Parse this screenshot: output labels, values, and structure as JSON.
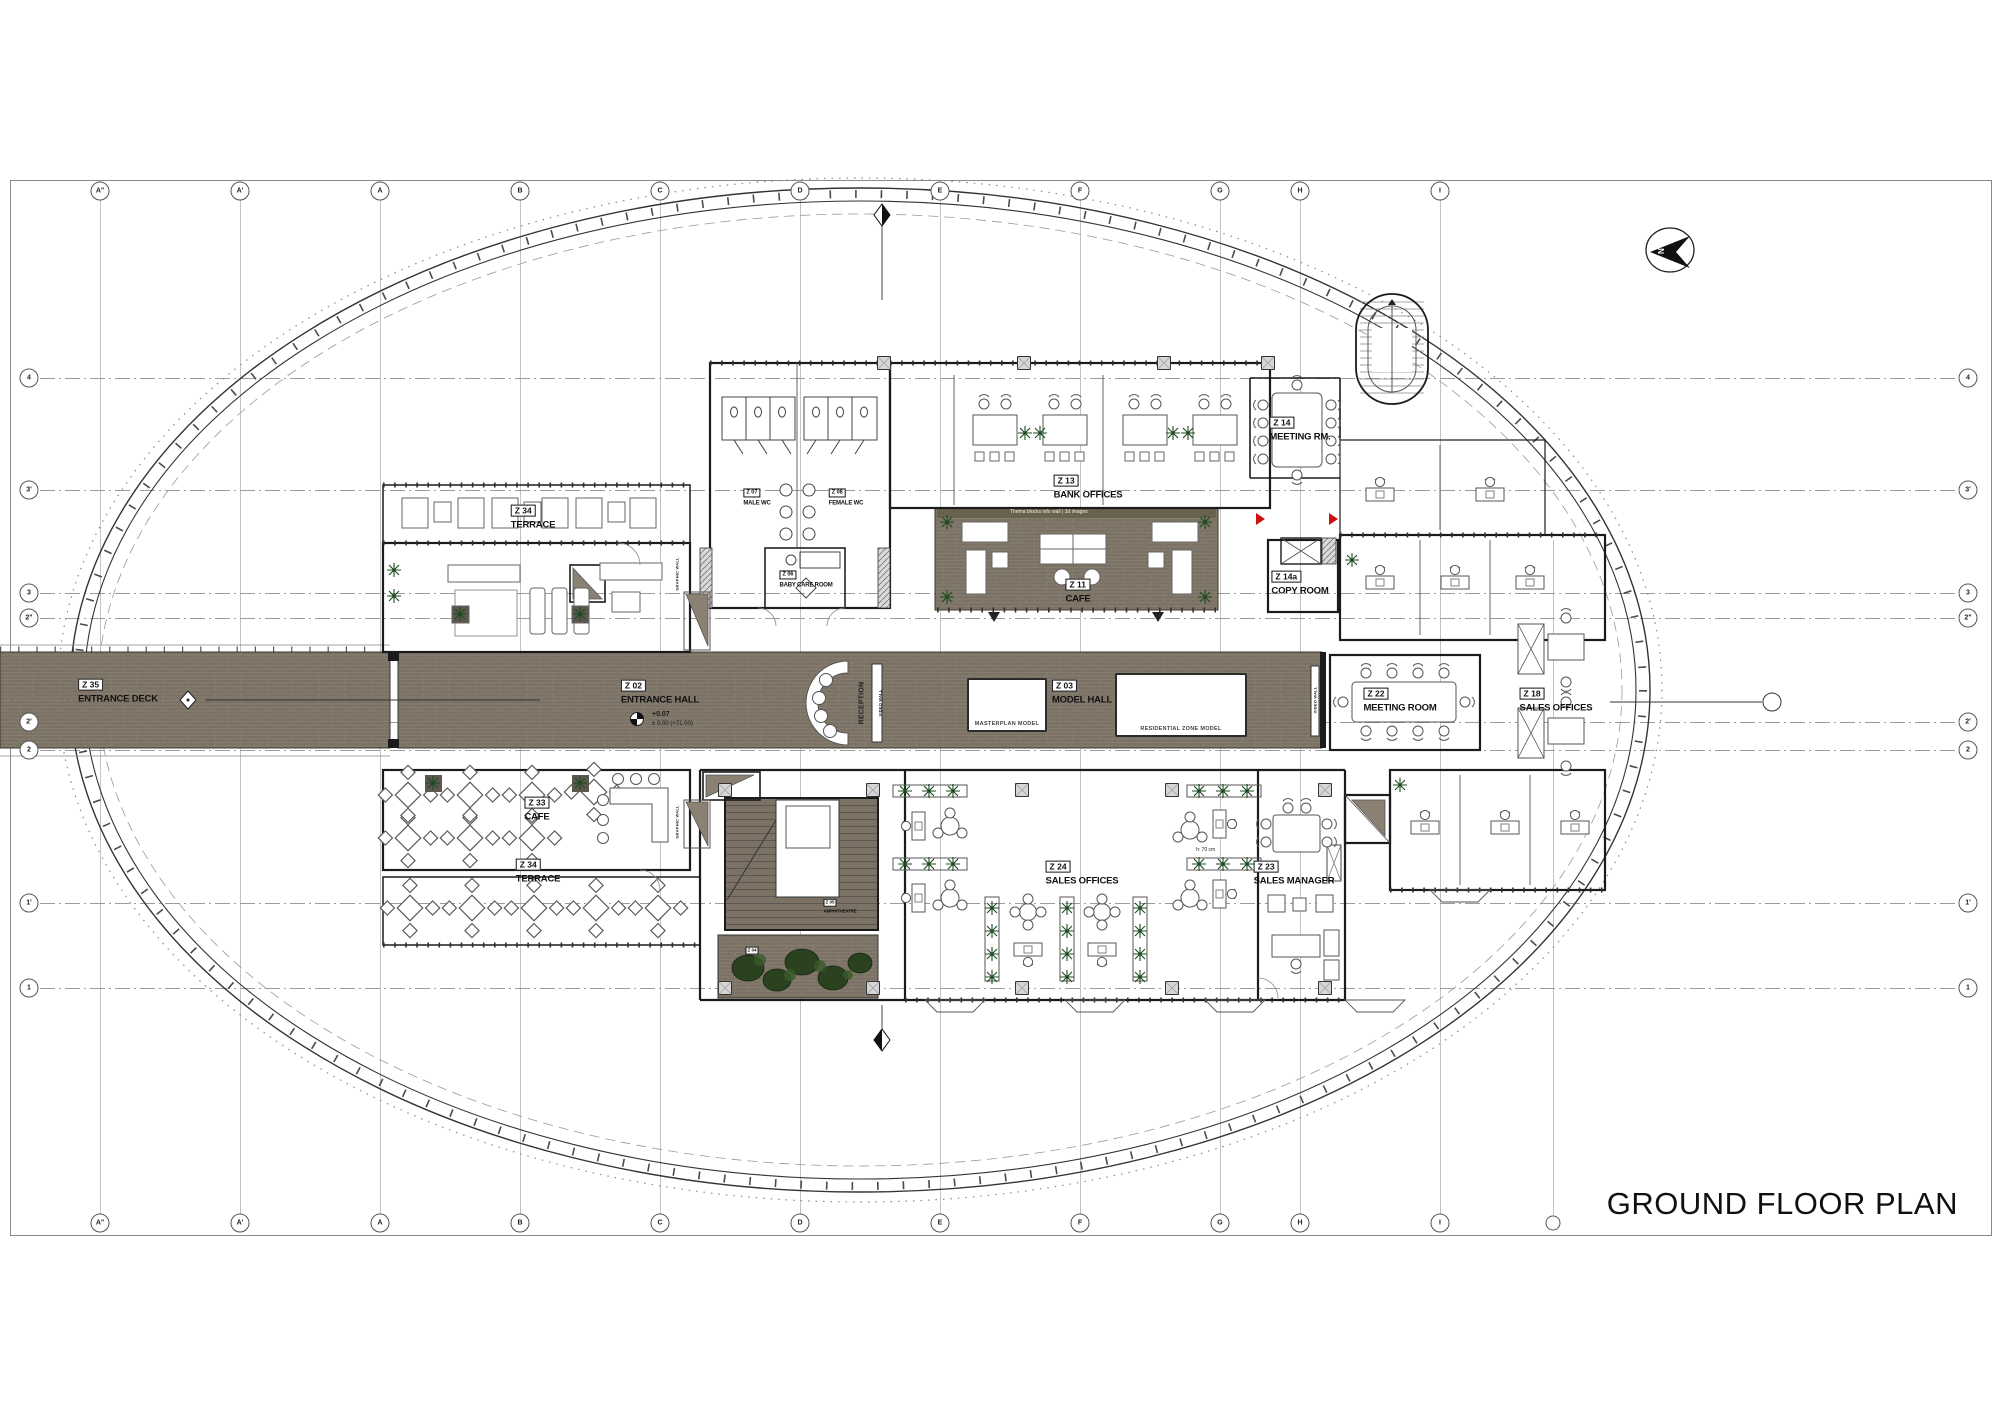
{
  "title": "GROUND FLOOR PLAN",
  "grid": {
    "marker_top_y": 191,
    "marker_bottom_y": 1223,
    "line_top": 200,
    "line_bottom": 1215,
    "marker_left_x": 29,
    "marker_right_x": 1968,
    "line_left": 40,
    "line_right": 1956,
    "columns": [
      {
        "label": "A\"",
        "x": 100
      },
      {
        "label": "A'",
        "x": 240
      },
      {
        "label": "A",
        "x": 380
      },
      {
        "label": "B",
        "x": 520
      },
      {
        "label": "C",
        "x": 660
      },
      {
        "label": "D",
        "x": 800
      },
      {
        "label": "E",
        "x": 940
      },
      {
        "label": "F",
        "x": 1080
      },
      {
        "label": "G",
        "x": 1220
      },
      {
        "label": "H",
        "x": 1300
      },
      {
        "label": "I",
        "x": 1440
      }
    ],
    "extra_columns": [
      {
        "label": "",
        "x": 1553,
        "y1": 540,
        "y2": 1215
      }
    ],
    "rows": [
      {
        "label": "4",
        "y": 378
      },
      {
        "label": "3'",
        "y": 490
      },
      {
        "label": "3",
        "y": 593
      },
      {
        "label": "2\"",
        "y": 618
      },
      {
        "label": "2'",
        "y": 722
      },
      {
        "label": "2",
        "y": 750
      },
      {
        "label": "1'",
        "y": 903
      },
      {
        "label": "1",
        "y": 988
      }
    ]
  },
  "rooms": [
    {
      "id": "Z 35",
      "name": "ENTRANCE DECK",
      "x": 118,
      "y": 690,
      "size": "md"
    },
    {
      "id": "Z 02",
      "name": "ENTRANCE HALL",
      "x": 660,
      "y": 691,
      "size": "md"
    },
    {
      "id": "Z 03",
      "name": "MODEL HALL",
      "x": 1082,
      "y": 691,
      "size": "md"
    },
    {
      "id": "Z 34",
      "name": "TERRACE",
      "x": 533,
      "y": 516,
      "size": "md"
    },
    {
      "id": "Z 13",
      "name": "BANK OFFICES",
      "x": 1088,
      "y": 486,
      "size": "md"
    },
    {
      "id": "Z 14",
      "name": "MEETING RM.",
      "x": 1300,
      "y": 428,
      "size": "md"
    },
    {
      "id": "Z 11",
      "name": "CAFE",
      "x": 1078,
      "y": 590,
      "size": "md"
    },
    {
      "id": "Z 14a",
      "name": "COPY ROOM",
      "x": 1300,
      "y": 582,
      "size": "md"
    },
    {
      "id": "Z 07",
      "name": "MALE WC",
      "x": 757,
      "y": 494,
      "size": "sm"
    },
    {
      "id": "Z 08",
      "name": "FEMALE WC",
      "x": 846,
      "y": 494,
      "size": "sm"
    },
    {
      "id": "Z 06",
      "name": "BABY CARE ROOM",
      "x": 806,
      "y": 576,
      "size": "sm"
    },
    {
      "id": "Z 22",
      "name": "MEETING ROOM",
      "x": 1400,
      "y": 699,
      "size": "md"
    },
    {
      "id": "Z 18",
      "name": "SALES OFFICES",
      "x": 1556,
      "y": 699,
      "size": "md"
    },
    {
      "id": "Z 33",
      "name": "CAFE",
      "x": 537,
      "y": 808,
      "size": "md"
    },
    {
      "id": "Z 34",
      "name": "TERRACE",
      "x": 538,
      "y": 870,
      "size": "md"
    },
    {
      "id": "Z 24",
      "name": "SALES OFFICES",
      "x": 1082,
      "y": 872,
      "size": "md"
    },
    {
      "id": "Z 23",
      "name": "SALES MANAGER",
      "x": 1294,
      "y": 872,
      "size": "md"
    },
    {
      "id": "Z 05",
      "name": "AMPHITHEATRE",
      "x": 840,
      "y": 903,
      "size": "xs"
    },
    {
      "id": "Z 04",
      "name": "",
      "x": 752,
      "y": 948,
      "size": "xs"
    }
  ],
  "wall_texts": [
    {
      "text": "RECEPTION",
      "x": 862,
      "y": 703,
      "size": 7
    },
    {
      "text": "VIDEO WALL",
      "x": 880,
      "y": 703,
      "size": 4
    },
    {
      "text": "VIDEO WALL",
      "x": 1315,
      "y": 700,
      "size": 4
    },
    {
      "text": "GRAPHIC WALL",
      "x": 677,
      "y": 574,
      "size": 4
    },
    {
      "text": "GRAPHIC WALL",
      "x": 677,
      "y": 822,
      "size": 4
    }
  ],
  "model_boxes": [
    {
      "text": "MASTERPLAN MODEL",
      "x": 967,
      "y": 678,
      "w": 76,
      "h": 47
    },
    {
      "text": "RESIDENTIAL ZONE MODEL",
      "x": 1115,
      "y": 673,
      "w": 128,
      "h": 57
    }
  ],
  "annotations": [
    {
      "text": "+0.07",
      "x": 652,
      "y": 711,
      "size": 7,
      "bold": true,
      "color": "#1c1c1c"
    },
    {
      "text": "± 0.00 (+71.00)",
      "x": 652,
      "y": 721,
      "size": 6,
      "bold": false,
      "color": "#1c1c1c"
    },
    {
      "text": "h: 70 cm",
      "x": 1196,
      "y": 847,
      "size": 5,
      "bold": false,
      "color": "#1c1c1c"
    },
    {
      "text": "Thema blocks info wall  |  3d images",
      "x": 1010,
      "y": 509,
      "size": 5,
      "bold": false,
      "color": "#efece2"
    }
  ],
  "colors": {
    "floor": "#7b7265",
    "floor_line": "#8a8172",
    "floor_edge": "#3c372f",
    "wall": "#1b1b1b",
    "furniture": "#4a4a4a",
    "green": "#1d4a1f",
    "tree": "#2a421f",
    "red": "#cc1111",
    "grid": "#9b9b9b"
  }
}
